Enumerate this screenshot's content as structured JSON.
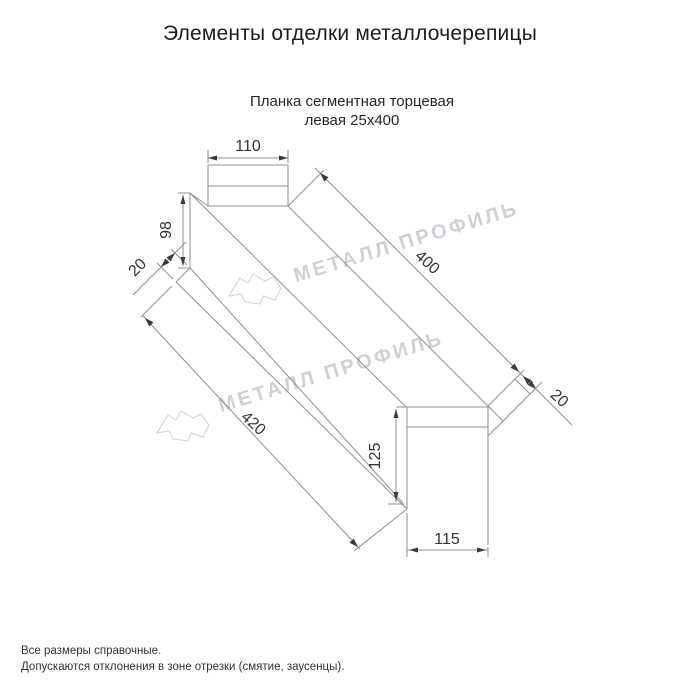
{
  "title": "Элементы отделки металлочерепицы",
  "product": {
    "subtitle_line1": "Планка сегментная торцевая",
    "subtitle_line2": "левая 25х400"
  },
  "dimensions": {
    "top_width": "110",
    "left_height": "98",
    "left_flap": "20",
    "top_length": "400",
    "right_flap": "20",
    "bottom_length": "420",
    "end_height": "125",
    "end_width": "115"
  },
  "watermark": {
    "text": "МЕТАЛЛ ПРОФИЛЬ"
  },
  "notes": {
    "line1": "Все размеры справочные.",
    "line2": "Допускаются отклонения в зоне отрезки (смятие, заусенцы)."
  },
  "colors": {
    "line": "#8f8f8f",
    "arrow": "#3a3a3a",
    "dim_text": "#333333",
    "watermark": "#cdd1d6",
    "logo_outline": "#d4d8dc"
  }
}
